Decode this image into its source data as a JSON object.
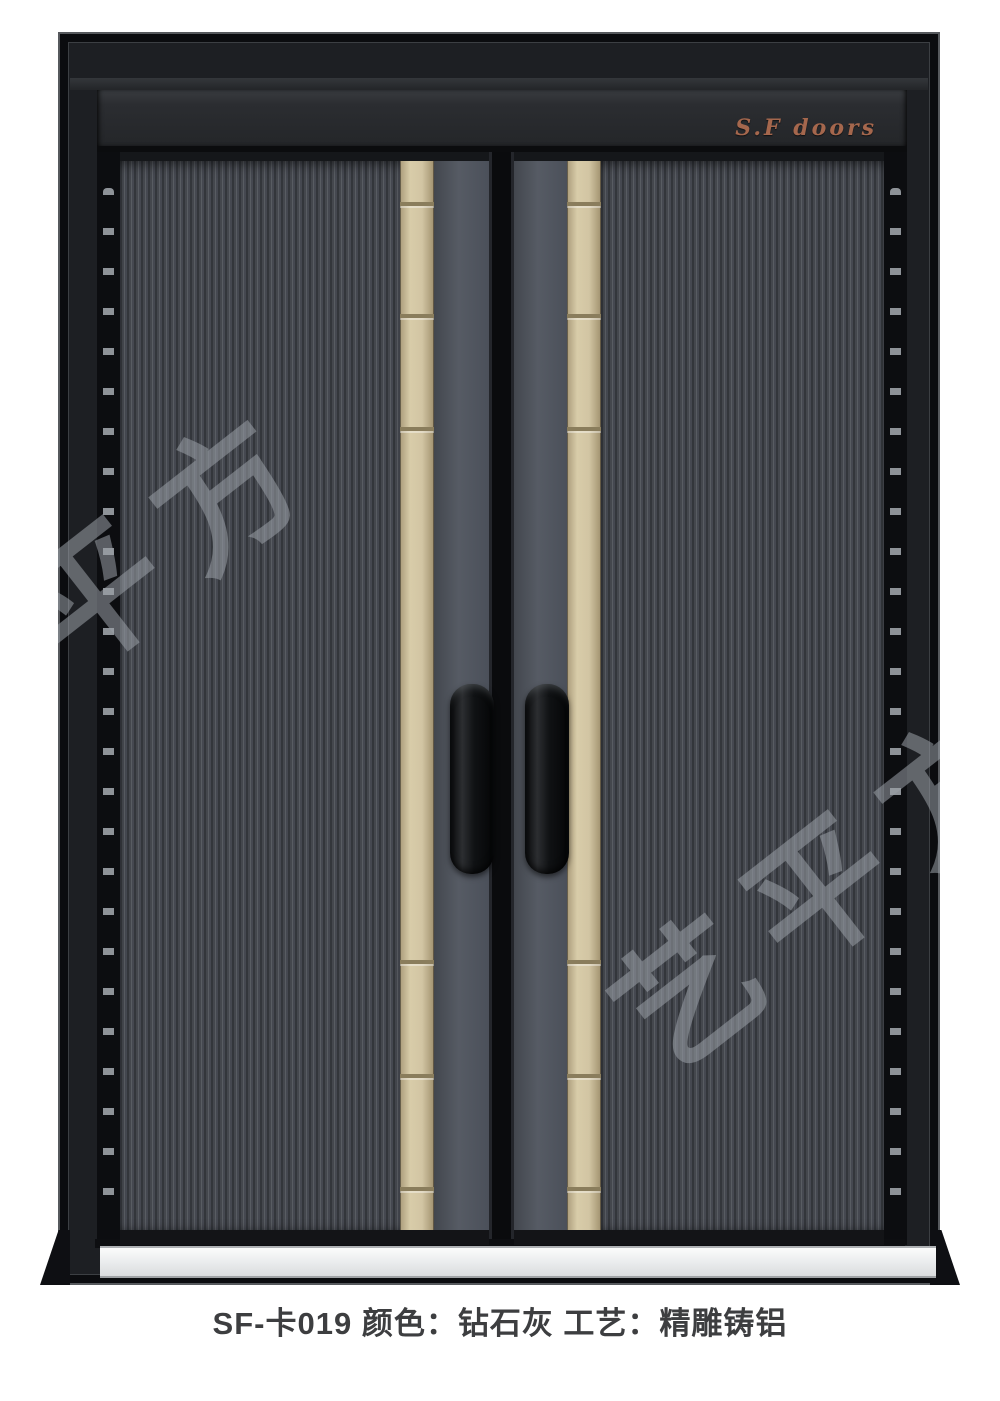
{
  "product": {
    "brand_mark": "S.F  doors",
    "caption": "SF-卡019 颜色：钻石灰  工艺：精雕铸铝",
    "model": "SF-卡019",
    "color_value": "钻石灰",
    "craft_value": "精雕铸铝"
  },
  "watermark": {
    "left_text": "艺平方",
    "right_text": "艺平方"
  },
  "colors": {
    "accent_gold": "#d2c5a3",
    "door_gray": "#45484e",
    "stile_gray": "#545964",
    "frame_black": "#141619",
    "brand_copper": "#a5674d",
    "sill_silver": "#e8eaec",
    "caption_text": "#3d3e40"
  }
}
